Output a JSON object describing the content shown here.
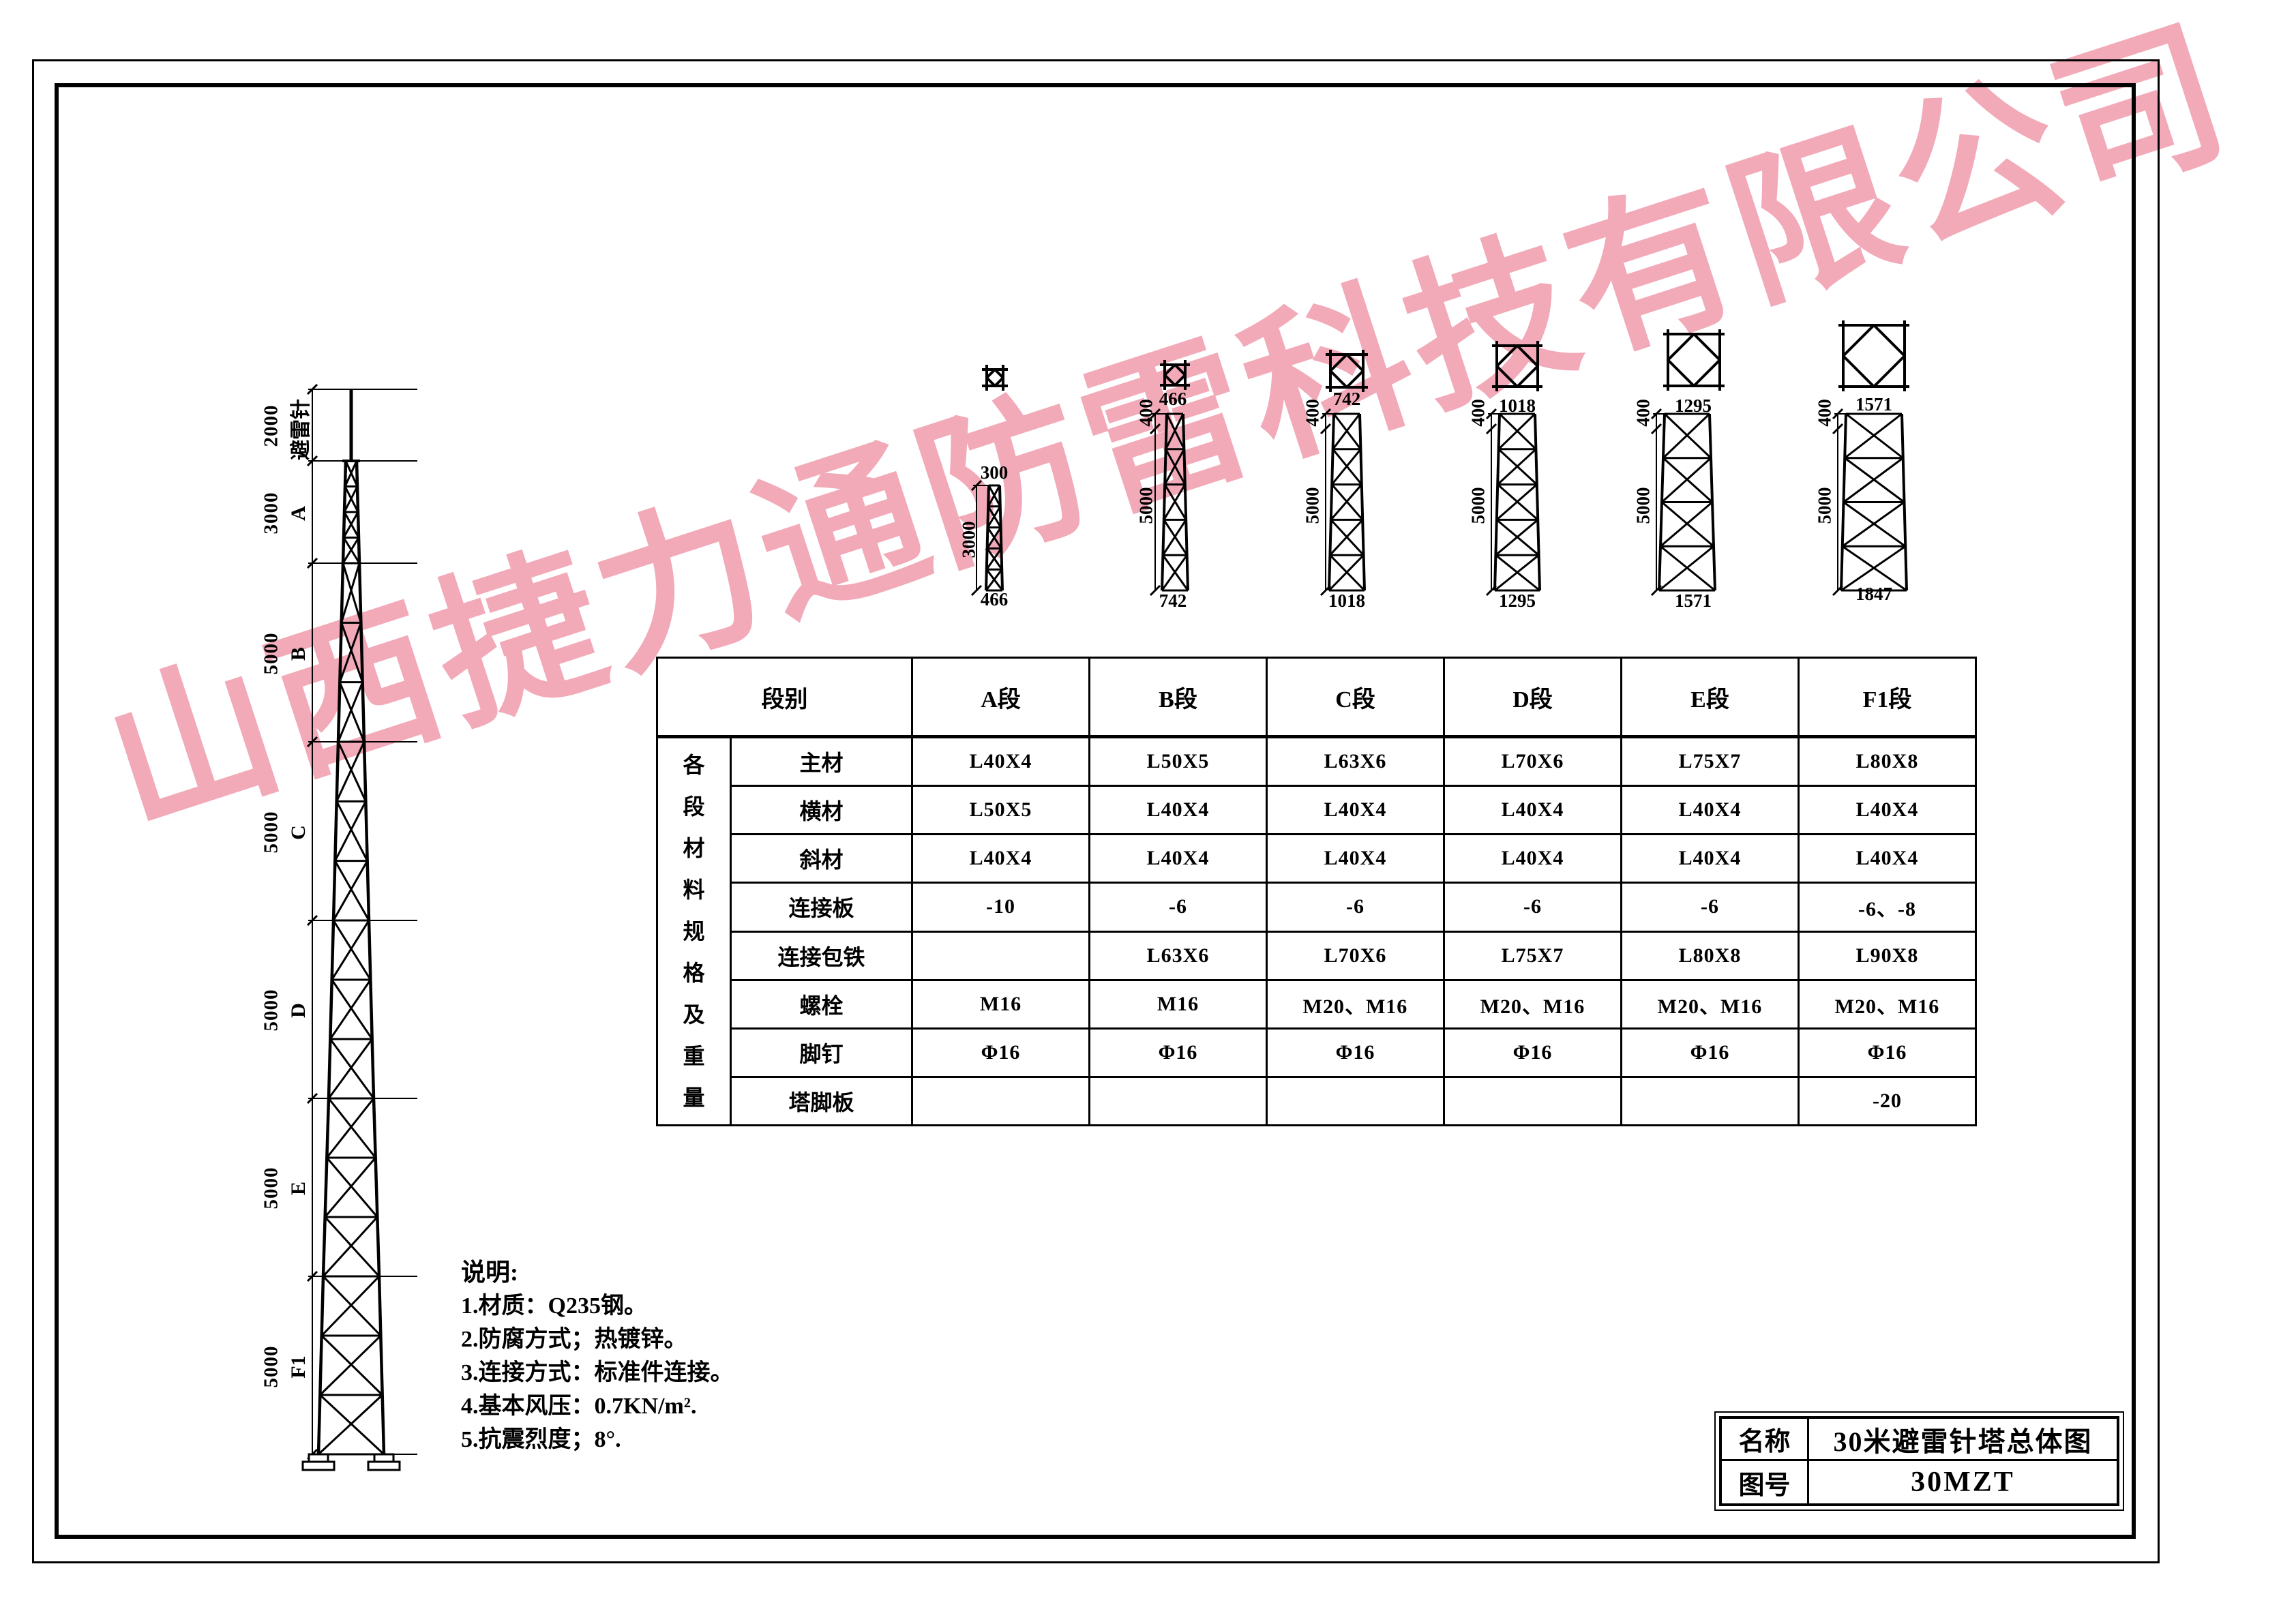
{
  "watermark": "山西捷力通防雷科技有限公司",
  "tower_elevation": {
    "sections": [
      {
        "label": "避雷针",
        "dim": "2000"
      },
      {
        "label": "A",
        "dim": "3000"
      },
      {
        "label": "B",
        "dim": "5000"
      },
      {
        "label": "C",
        "dim": "5000"
      },
      {
        "label": "D",
        "dim": "5000"
      },
      {
        "label": "E",
        "dim": "5000"
      },
      {
        "label": "F1",
        "dim": "5000"
      }
    ]
  },
  "section_details": [
    {
      "name": "A",
      "top_width": "300",
      "height": "3000",
      "bottom_width": "466",
      "top_offset": ""
    },
    {
      "name": "B",
      "top_width": "466",
      "height": "5000",
      "bottom_width": "742",
      "top_offset": "400"
    },
    {
      "name": "C",
      "top_width": "742",
      "height": "5000",
      "bottom_width": "1018",
      "top_offset": "400"
    },
    {
      "name": "D",
      "top_width": "1018",
      "height": "5000",
      "bottom_width": "1295",
      "top_offset": "400"
    },
    {
      "name": "E",
      "top_width": "1295",
      "height": "5000",
      "bottom_width": "1571",
      "top_offset": "400"
    },
    {
      "name": "F1",
      "top_width": "1571",
      "height": "5000",
      "bottom_width": "1847",
      "top_offset": "400"
    }
  ],
  "spec_table": {
    "corner_label": "段别",
    "group_label": "各段材料规格及重量",
    "columns": [
      "A段",
      "B段",
      "C段",
      "D段",
      "E段",
      "F1段"
    ],
    "rows": [
      {
        "label": "主材",
        "cells": [
          "L40X4",
          "L50X5",
          "L63X6",
          "L70X6",
          "L75X7",
          "L80X8"
        ]
      },
      {
        "label": "横材",
        "cells": [
          "L50X5",
          "L40X4",
          "L40X4",
          "L40X4",
          "L40X4",
          "L40X4"
        ]
      },
      {
        "label": "斜材",
        "cells": [
          "L40X4",
          "L40X4",
          "L40X4",
          "L40X4",
          "L40X4",
          "L40X4"
        ]
      },
      {
        "label": "连接板",
        "cells": [
          "-10",
          "-6",
          "-6",
          "-6",
          "-6",
          "-6、-8"
        ]
      },
      {
        "label": "连接包铁",
        "cells": [
          "",
          "L63X6",
          "L70X6",
          "L75X7",
          "L80X8",
          "L90X8"
        ]
      },
      {
        "label": "螺栓",
        "cells": [
          "M16",
          "M16",
          "M20、M16",
          "M20、M16",
          "M20、M16",
          "M20、M16"
        ]
      },
      {
        "label": "脚钉",
        "cells": [
          "Φ16",
          "Φ16",
          "Φ16",
          "Φ16",
          "Φ16",
          "Φ16"
        ]
      },
      {
        "label": "塔脚板",
        "cells": [
          "",
          "",
          "",
          "",
          "",
          "-20"
        ]
      }
    ]
  },
  "notes": {
    "title": "说明:",
    "items": [
      "1.材质：Q235钢。",
      "2.防腐方式；热镀锌。",
      "3.连接方式：标准件连接。",
      "4.基本风压：0.7KN/m².",
      "5.抗震烈度；8°."
    ]
  },
  "title_block": {
    "name_label": "名称",
    "name_value": "30米避雷针塔总体图",
    "number_label": "图号",
    "number_value": "30MZT"
  }
}
